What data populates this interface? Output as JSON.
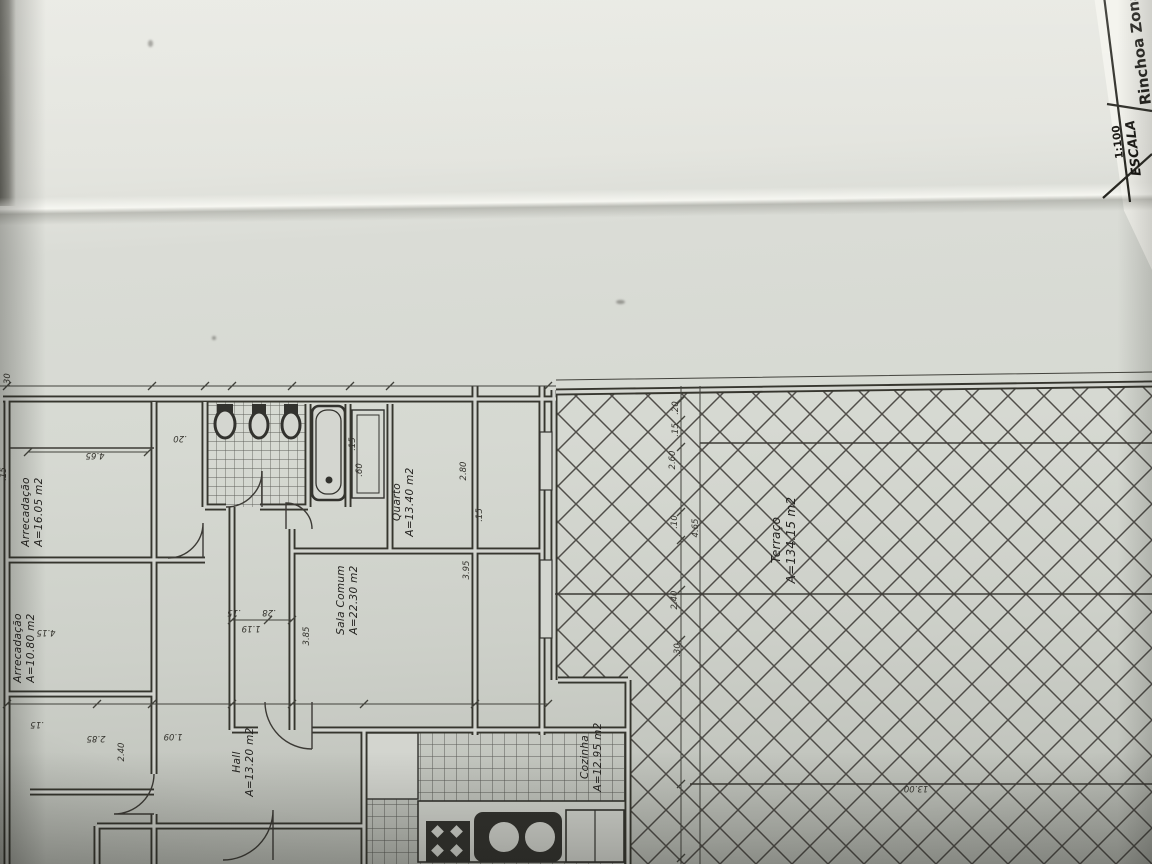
{
  "title_block": {
    "project": "Rinchoa Zona",
    "scale_label": "ESCALA",
    "scale_value": "1:100"
  },
  "rooms": [
    {
      "name": "Arrecadação",
      "area": "A=16.05 m2"
    },
    {
      "name": "Arrecadação",
      "area": "A=10.80 m2"
    },
    {
      "name": "Hall",
      "area": "A=13.20 m2"
    },
    {
      "name": "Sala Comum",
      "area": "A=22.30 m2"
    },
    {
      "name": "Quarto",
      "area": "A=13.40 m2"
    },
    {
      "name": "Cozinha",
      "area": "A=12.95 m2"
    },
    {
      "name": "Terraço",
      "area": "A=134.15 m2"
    }
  ],
  "dimensions": [
    ".30",
    "4.65",
    ".20",
    ".15",
    "4.15",
    "2.80",
    ".15",
    "3.95",
    ".15",
    ".60",
    "2.85",
    ".15",
    "1.09",
    "2.40",
    "1.19",
    ".15",
    ".28",
    "3.85",
    "13.00",
    ".20",
    ".15",
    "2.60",
    ".10",
    "4.65",
    "2.40",
    ".30"
  ]
}
